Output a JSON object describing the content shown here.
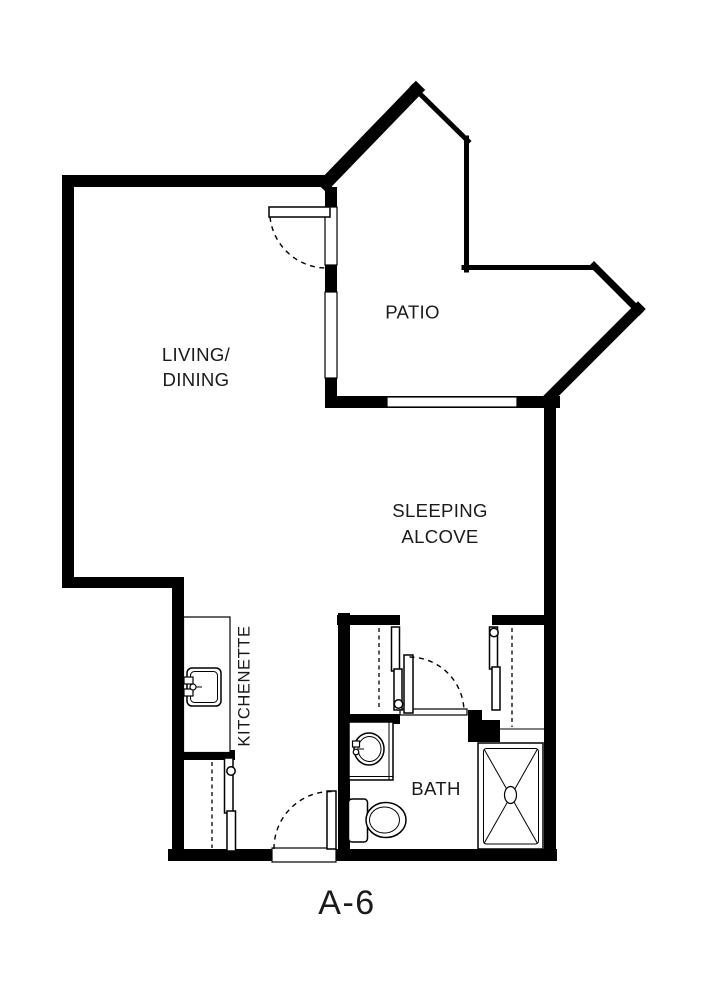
{
  "colors": {
    "background": "#ffffff",
    "wall": "#000000",
    "text": "#1a1a1a"
  },
  "unit_label": "A-6",
  "rooms": {
    "living_dining": {
      "line1": "LIVING/",
      "line2": "DINING"
    },
    "patio": {
      "label": "PATIO"
    },
    "sleeping_alcove": {
      "line1": "SLEEPING",
      "line2": "ALCOVE"
    },
    "kitchenette": {
      "label": "KITCHENETTE"
    },
    "bath": {
      "label": "BATH"
    }
  },
  "fixtures": [
    "kitchen-sink",
    "bathroom-sink",
    "toilet",
    "shower",
    "closet-rods",
    "sliding-doors"
  ]
}
